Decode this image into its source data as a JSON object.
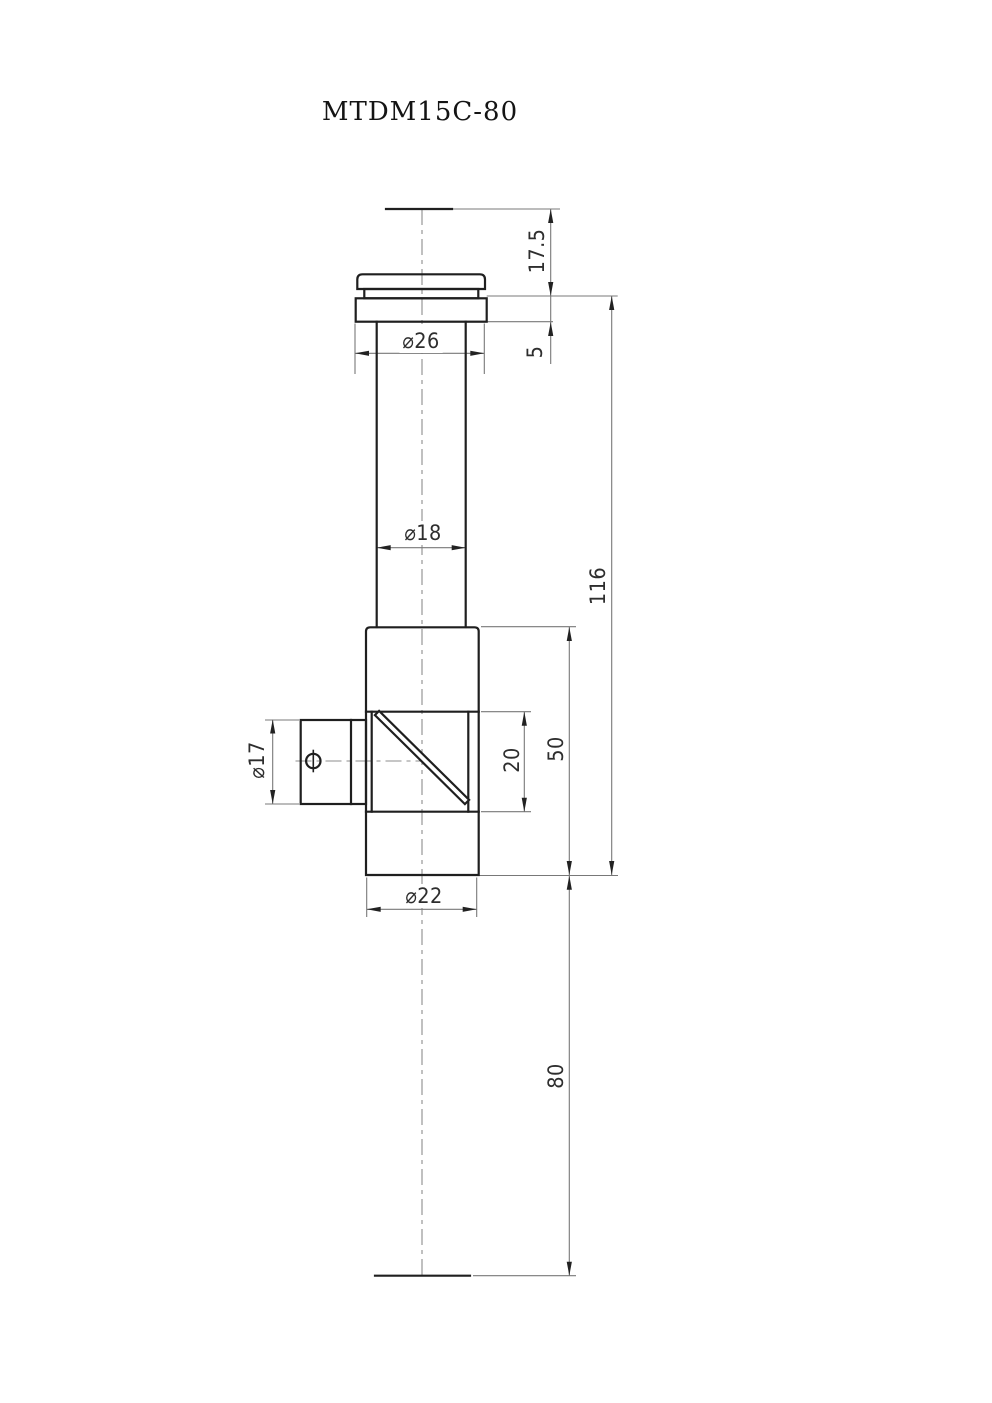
{
  "title": "MTDM15C-80",
  "dimensions": {
    "cap_height": "17.5",
    "flange_thickness": "5",
    "flange_diameter": "⌀26",
    "tube_diameter": "⌀18",
    "upper_length": "116",
    "side_port_diameter": "⌀17",
    "prism_window_length": "20",
    "body_length": "50",
    "body_diameter": "⌀22",
    "lower_length": "80"
  },
  "colors": {
    "object_line": "#1f1f1f",
    "thin_line": "#787878",
    "centerline": "#8c8c8c",
    "arrow": "#222222",
    "background": "#ffffff"
  }
}
